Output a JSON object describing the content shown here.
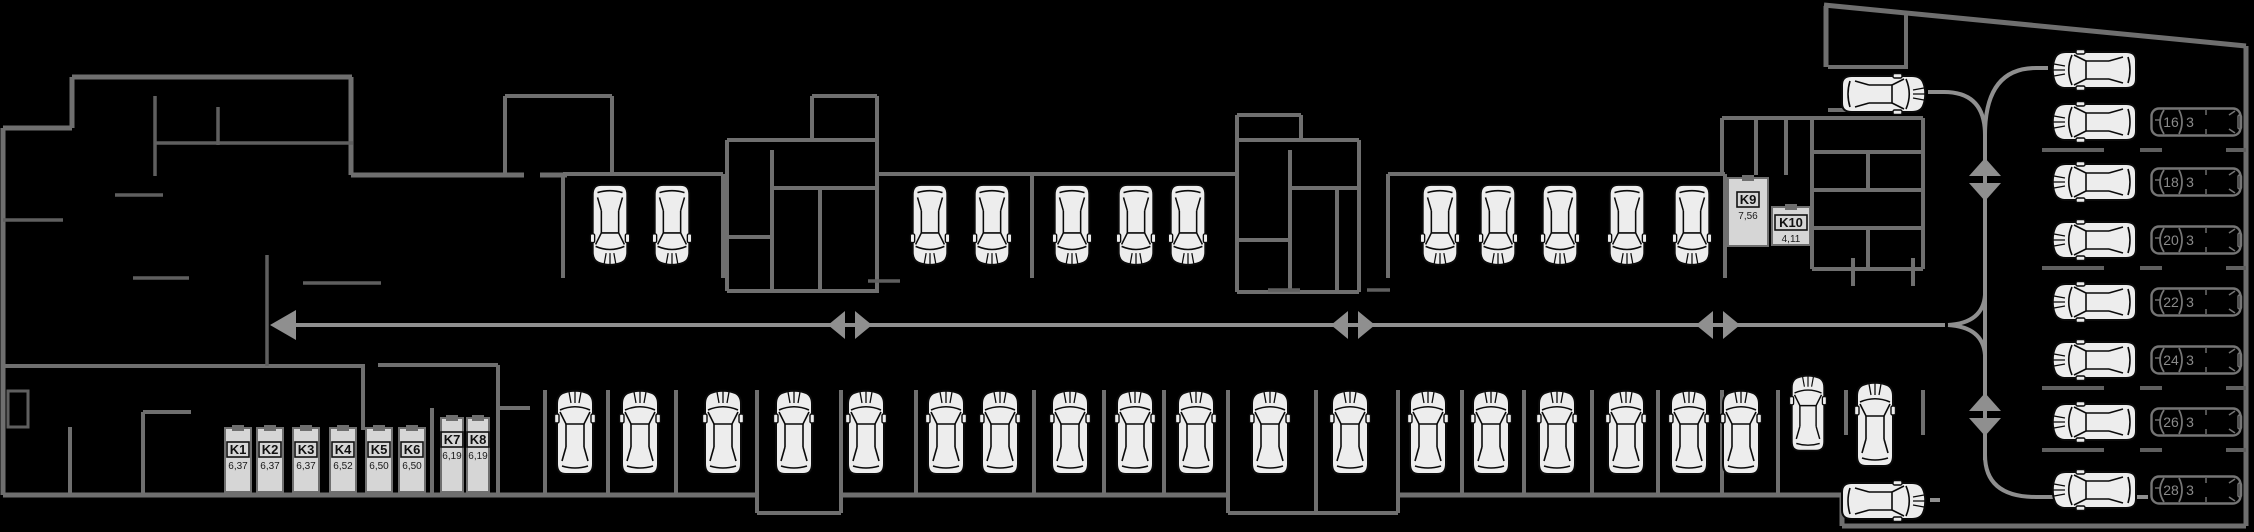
{
  "floor_plan": {
    "title": "parking-level-floor-plan",
    "storage_units": [
      {
        "label": "K1",
        "area": "6,37"
      },
      {
        "label": "K2",
        "area": "6,37"
      },
      {
        "label": "K3",
        "area": "6,37"
      },
      {
        "label": "K4",
        "area": "6,52"
      },
      {
        "label": "K5",
        "area": "6,50"
      },
      {
        "label": "K6",
        "area": "6,50"
      },
      {
        "label": "K7",
        "area": "6,19"
      },
      {
        "label": "K8",
        "area": "6,19"
      },
      {
        "label": "K9",
        "area": "7,56"
      },
      {
        "label": "K10",
        "area": "4,11"
      }
    ],
    "parking_spots": [
      {
        "label": "16",
        "suffix": "3"
      },
      {
        "label": "18",
        "suffix": "3"
      },
      {
        "label": "20",
        "suffix": "3"
      },
      {
        "label": "22",
        "suffix": "3"
      },
      {
        "label": "24",
        "suffix": "3"
      },
      {
        "label": "26",
        "suffix": "3"
      },
      {
        "label": "28",
        "suffix": "3"
      }
    ],
    "car_counts": {
      "top_row": 12,
      "bottom_row": 19,
      "right_column_parked": 8,
      "right_column_numbered": 7,
      "exit_area": 3
    },
    "colors": {
      "background": "#000000",
      "walls": "#6f6f6f",
      "inner_walls": "#5f5f5f",
      "circulation": "#8f8f8f",
      "car_fill": "#ededed",
      "car_outline": "#0a0a0a",
      "spot_outline": "#757575",
      "spot_text": "#8a8a8a",
      "unit_fill": "#d6d6d6",
      "label_text": "#111111"
    }
  }
}
